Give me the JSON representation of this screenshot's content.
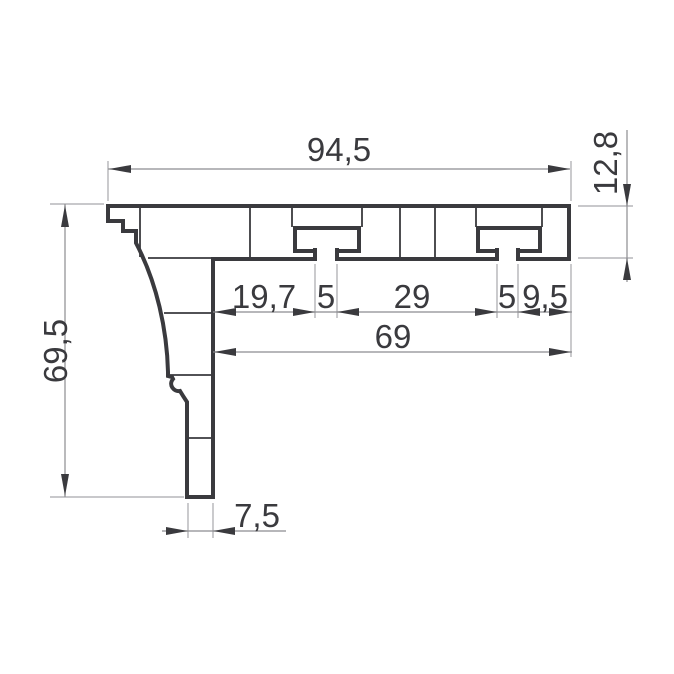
{
  "drawing": {
    "type": "technical-profile-cross-section",
    "units_style": "comma-decimal",
    "dimensions": {
      "overall_width": "94,5",
      "top_bar_thickness": "12,8",
      "overall_height": "69,5",
      "leg_to_slot1": "19,7",
      "slot1_opening": "5",
      "slot1_to_slot2": "29",
      "slot2_opening": "5",
      "slot2_to_right_edge": "9,5",
      "inner_width": "69",
      "leg_thickness": "7,5"
    },
    "colors": {
      "profile_line": "#3a3a3e",
      "dimension_line": "#8c8c90",
      "extension_line": "#a8a8ac",
      "text": "#3a3a3e",
      "background": "#ffffff"
    }
  }
}
